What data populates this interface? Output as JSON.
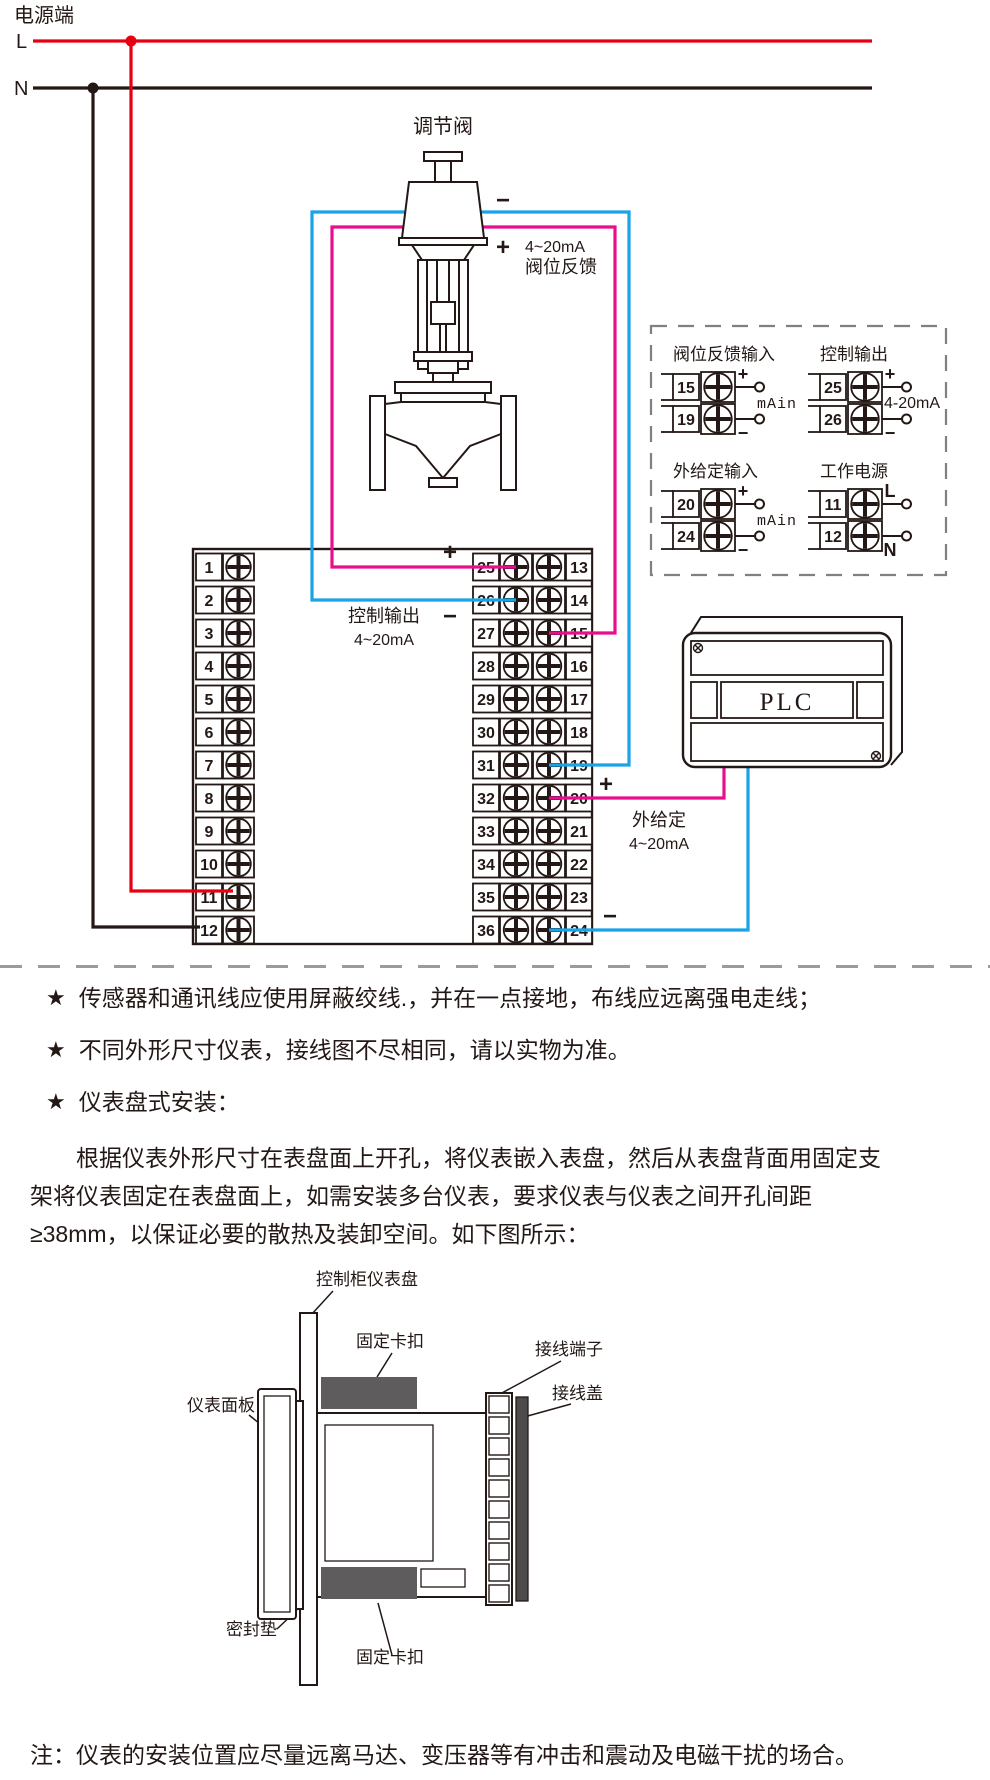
{
  "palette": {
    "red": "#e60012",
    "magenta": "#e80e8d",
    "blue": "#18a4e6",
    "ink": "#231815",
    "dash_gray": "#9b9b9b",
    "clip_gray": "#5e5c5c",
    "cover_gray": "#4d4b4b"
  },
  "power": {
    "title": "电源端",
    "l": "L",
    "n": "N"
  },
  "valve": {
    "label": "调节阀",
    "minus": "−",
    "plus": "+",
    "feedback": [
      "4~20mA",
      "阀位反馈"
    ]
  },
  "terminal_block": {
    "left": [
      "1",
      "2",
      "3",
      "4",
      "5",
      "6",
      "7",
      "8",
      "9",
      "10",
      "11",
      "12"
    ],
    "inner": [
      "25",
      "26",
      "27",
      "28",
      "29",
      "30",
      "31",
      "32",
      "33",
      "34",
      "35",
      "36"
    ],
    "outer": [
      "13",
      "14",
      "15",
      "16",
      "17",
      "18",
      "19",
      "20",
      "21",
      "22",
      "23",
      "24"
    ]
  },
  "control_output": {
    "plus": "+",
    "minus": "−",
    "lines": [
      "控制输出",
      "4~20mA"
    ]
  },
  "external_setpoint": {
    "plus": "+",
    "minus": "−",
    "lines": [
      "外给定",
      "4~20mA"
    ]
  },
  "plc": {
    "label": "PLC"
  },
  "legend": {
    "groups": [
      {
        "title": "阀位反馈输入",
        "rows": [
          {
            "no": "15",
            "tag": "+"
          },
          {
            "no": "19",
            "tag": "−"
          }
        ],
        "note": "mAin"
      },
      {
        "title": "控制输出",
        "rows": [
          {
            "no": "25",
            "tag": "+"
          },
          {
            "no": "26",
            "tag": "−"
          }
        ],
        "note": "4-20mA"
      },
      {
        "title": "外给定输入",
        "rows": [
          {
            "no": "20",
            "tag": "+"
          },
          {
            "no": "24",
            "tag": "−"
          }
        ],
        "note": "mAin"
      },
      {
        "title": "工作电源",
        "rows": [
          {
            "no": "11",
            "tag": "L"
          },
          {
            "no": "12",
            "tag": "N"
          }
        ],
        "note": ""
      }
    ]
  },
  "notes": {
    "bullet_icon": "★",
    "bullets": [
      "传感器和通讯线应使用屏蔽绞线.，并在一点接地，布线应远离强电走线；",
      "不同外形尺寸仪表，接线图不尽相同，请以实物为准。",
      "仪表盘式安装："
    ],
    "paragraph": "根据仪表外形尺寸在表盘面上开孔，将仪表嵌入表盘，然后从表盘背面用固定支架将仪表固定在表盘面上，如需安装多台仪表，要求仪表与仪表之间开孔间距≥38mm，以保证必要的散热及装卸空间。如下图所示：",
    "footnote": "注：仪表的安装位置应尽量远离马达、变压器等有冲击和震动及电磁干扰的场合。"
  },
  "installation": {
    "labels": {
      "panel": "控制柜仪表盘",
      "clip_top": "固定卡扣",
      "terminal": "接线端子",
      "cover": "接线盖",
      "front": "仪表面板",
      "gasket": "密封垫",
      "clip_bottom": "固定卡扣"
    }
  }
}
